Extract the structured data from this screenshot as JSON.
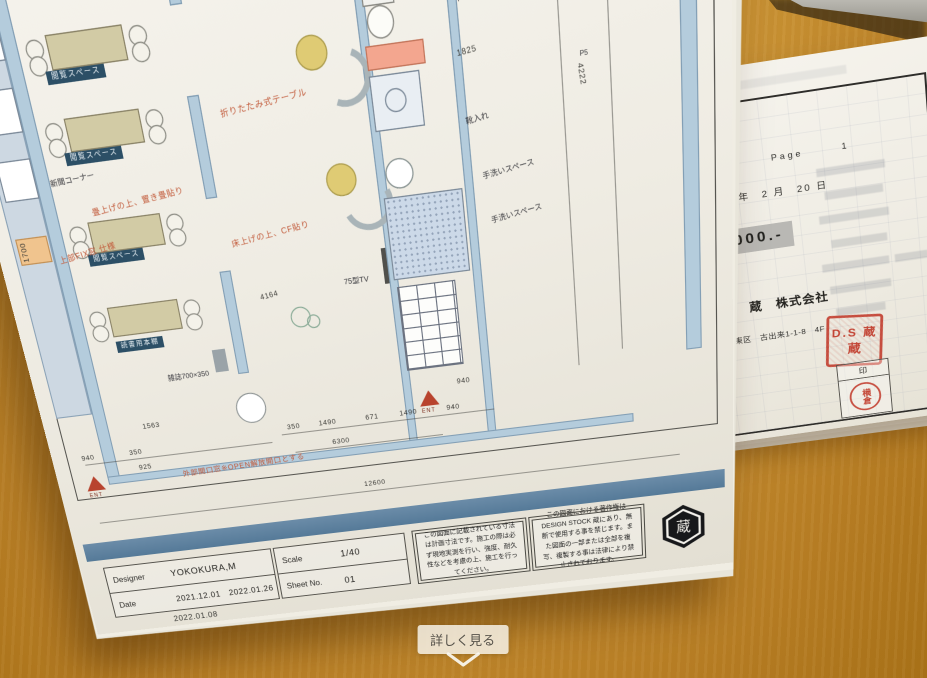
{
  "palette": {
    "desk_wood": "#cd9636",
    "plan_teal": "#c0e1d7",
    "plan_wall_blue": "#b4ccdc",
    "plan_navy_label": "#2c4f66",
    "plan_red_note": "#c25a3a",
    "band_blue": "#5d82a0",
    "stamp_red": "#bf3424",
    "highlight_gray": "#b9b8b4"
  },
  "overlay": {
    "detail_button_label": "詳しく見る"
  },
  "plan": {
    "dim_top": "12600",
    "outdoor_units": [
      "室外機",
      "室外機",
      "室外機",
      "室外機"
    ],
    "p5_a": "P5",
    "p5_b": "P5",
    "labels": {
      "viewing_space_1": "閲覧スペース",
      "viewing_space_2": "閲覧スペース",
      "viewing_space_3": "閲覧スペース",
      "magazine_shelf": "雑誌用本棚",
      "reading_shelf": "読書用本棚",
      "newspaper_corner": "新聞コーナー",
      "magazine_rack": "雑誌700×350",
      "tv": "75型TV",
      "toilet_storage": "トイレ内収納",
      "shoe_storage": "靴入れ",
      "handwash_1": "手洗いスペース",
      "handwash_2": "手洗いスペース",
      "ent_1": "ENT",
      "ent_2": "ENT"
    },
    "red_notes": {
      "window": "外部開口窓※OPEN解放開口とする",
      "folding_table": "折りたたみ式テーブル",
      "tatami": "畳上げの上、置き畳貼り",
      "floor": "床上げの上、CF貼り",
      "fix_window": "上部FIX窓 仕様"
    },
    "dims": {
      "bottom": [
        "940",
        "350",
        "350",
        "1490",
        "671",
        "1490",
        "940"
      ],
      "bottom_total": "6300",
      "bottom_overall": "12600",
      "left_v": "1700",
      "left_a": "1563",
      "left_b": "925",
      "right": [
        "2745",
        "4164",
        "1825",
        "4222",
        "940"
      ]
    },
    "title_block": {
      "designer_label": "Designer",
      "designer_value": "YOKOKURA,M",
      "date_label": "Date",
      "date_value": "2021.12.01　2022.01.26",
      "date_value_2": "2022.01.08",
      "scale_label": "Scale",
      "scale_value": "1/40",
      "sheet_label": "Sheet No.",
      "sheet_value": "01"
    },
    "note_1": "この図面に記載されている寸法は計画寸法です。施工の際は必ず現地実測を行い、強度、耐久性などを考慮の上、施工を行ってください。",
    "note_2": "この図面における著作権はDESIGN STOCK 蔵にあり、無断で使用する事を禁じます。また図面の一部または全部を複写、複製する事は法律により禁止されております。",
    "logo_kanji": "蔵"
  },
  "estimate": {
    "title": "見積書",
    "page_label": "Page",
    "page_value": "1",
    "date_line": "令和　4 年　2 月　20 日",
    "amount_visible": "0,000.-",
    "company": "DesignStock　蔵　株式会社",
    "postal": "〒461-0049",
    "address": "愛知県　名古屋市　東区　古出来1-1-8　4F",
    "tel": "： 052-693-6698",
    "fax": "： 052-307-3269",
    "seal_box_label": "印",
    "square_seal": "D.S 蔵",
    "round_stamp": "横倉"
  }
}
